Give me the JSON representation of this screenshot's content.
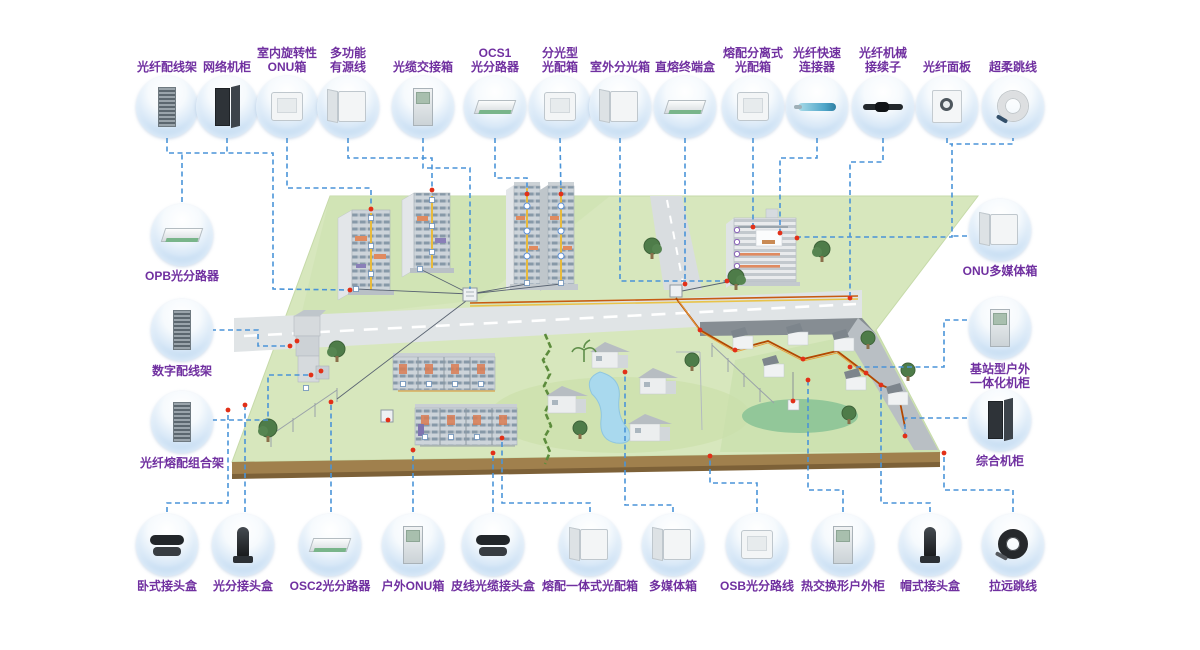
{
  "palette": {
    "label_color": "#7030a0",
    "connector_color": "#4a94d8",
    "node_red": "#e23018",
    "land_green": "#d7e7bd",
    "road_gray": "#dfe3e5",
    "cable_orange": "#c75b12",
    "cable_yellow": "#e8c34a"
  },
  "items": {
    "top": [
      {
        "id": "fiber-distribution-frame",
        "label": "光纤配线架",
        "icon": "rack",
        "cx": 167,
        "cy": 107
      },
      {
        "id": "network-cabinet",
        "label": "网络机柜",
        "icon": "cabinet-dark",
        "cx": 227,
        "cy": 107
      },
      {
        "id": "indoor-rotary-onu-box",
        "label": "室内旋转性\nONU箱",
        "icon": "wallbox",
        "cx": 287,
        "cy": 107
      },
      {
        "id": "multifunction-active-box",
        "label": "多功能\n有源线",
        "icon": "wallbox-open",
        "cx": 348,
        "cy": 107
      },
      {
        "id": "cable-cross-connect-cabinet",
        "label": "光缆交接箱",
        "icon": "cabinet",
        "cx": 423,
        "cy": 107
      },
      {
        "id": "ocs1-splitter",
        "label": "OCS1\n光分路器",
        "icon": "tray",
        "cx": 495,
        "cy": 107
      },
      {
        "id": "splitting-odb",
        "label": "分光型\n光配箱",
        "icon": "wallbox",
        "cx": 560,
        "cy": 107
      },
      {
        "id": "outdoor-splitting-box",
        "label": "室外分光箱",
        "icon": "wallbox-open",
        "cx": 620,
        "cy": 107
      },
      {
        "id": "direct-splice-terminal-box",
        "label": "直熔终端盒",
        "icon": "tray",
        "cx": 685,
        "cy": 107
      },
      {
        "id": "splice-distribution-separate-odb",
        "label": "熔配分离式\n光配箱",
        "icon": "wallbox",
        "cx": 753,
        "cy": 107
      },
      {
        "id": "fiber-quick-connector",
        "label": "光纤快速\n连接器",
        "icon": "connector-blue",
        "cx": 817,
        "cy": 107
      },
      {
        "id": "fiber-mechanical-splice",
        "label": "光纤机械\n接续子",
        "icon": "connector-dark",
        "cx": 883,
        "cy": 107
      },
      {
        "id": "fiber-faceplate",
        "label": "光纤面板",
        "icon": "panel",
        "cx": 947,
        "cy": 107
      },
      {
        "id": "ultra-flexible-patch-cord",
        "label": "超柔跳线",
        "icon": "coil-light",
        "cx": 1013,
        "cy": 107
      }
    ],
    "left": [
      {
        "id": "opb-splitter",
        "label": "OPB光分路器",
        "icon": "tray",
        "cx": 182,
        "cy": 235
      },
      {
        "id": "digital-distribution-frame",
        "label": "数字配线架",
        "icon": "rack",
        "cx": 182,
        "cy": 330
      },
      {
        "id": "fiber-splice-distribution-frame",
        "label": "光纤熔配组合架",
        "icon": "rack",
        "cx": 182,
        "cy": 422
      }
    ],
    "right": [
      {
        "id": "onu-multimedia-box",
        "label": "ONU多媒体箱",
        "icon": "wallbox-open",
        "cx": 1000,
        "cy": 230
      },
      {
        "id": "base-station-outdoor-cabinet",
        "label": "基站型户外\n一体化机柜",
        "icon": "cabinet",
        "cx": 1000,
        "cy": 328
      },
      {
        "id": "integrated-cabinet",
        "label": "综合机柜",
        "icon": "cabinet-dark",
        "cx": 1000,
        "cy": 420
      }
    ],
    "bottom": [
      {
        "id": "horizontal-closure",
        "label": "卧式接头盒",
        "icon": "closure-flat",
        "cx": 167,
        "cy": 545
      },
      {
        "id": "splitting-closure",
        "label": "光分接头盒",
        "icon": "closure-dome",
        "cx": 243,
        "cy": 545
      },
      {
        "id": "osc2-splitter",
        "label": "OSC2光分路器",
        "icon": "tray",
        "cx": 330,
        "cy": 545
      },
      {
        "id": "outdoor-onu-box",
        "label": "户外ONU箱",
        "icon": "cabinet",
        "cx": 413,
        "cy": 545
      },
      {
        "id": "drop-cable-closure",
        "label": "皮线光缆接头盒",
        "icon": "closure-flat",
        "cx": 493,
        "cy": 545
      },
      {
        "id": "integrated-splice-odb",
        "label": "熔配一体式光配箱",
        "icon": "wallbox-open",
        "cx": 590,
        "cy": 545
      },
      {
        "id": "multimedia-box",
        "label": "多媒体箱",
        "icon": "wallbox-open",
        "cx": 673,
        "cy": 545
      },
      {
        "id": "osb-splitter",
        "label": "OSB光分路线",
        "icon": "wallbox",
        "cx": 757,
        "cy": 545
      },
      {
        "id": "heat-exchange-outdoor-cabinet",
        "label": "热交换形户外柜",
        "icon": "cabinet",
        "cx": 843,
        "cy": 545
      },
      {
        "id": "cap-type-closure",
        "label": "帽式接头盒",
        "icon": "closure-dome",
        "cx": 930,
        "cy": 545
      },
      {
        "id": "remote-patch-cord",
        "label": "拉远跳线",
        "icon": "coil-dark",
        "cx": 1013,
        "cy": 545
      }
    ]
  },
  "connectors": [
    {
      "from": "fiber-distribution-frame",
      "points": [
        [
          167,
          138
        ],
        [
          167,
          153
        ],
        [
          273,
          153
        ],
        [
          273,
          289
        ],
        [
          350,
          290
        ]
      ]
    },
    {
      "from": "network-cabinet",
      "points": [
        [
          227,
          138
        ],
        [
          227,
          153
        ]
      ]
    },
    {
      "from": "indoor-rotary-onu-box",
      "points": [
        [
          287,
          138
        ],
        [
          287,
          188
        ],
        [
          371,
          188
        ],
        [
          371,
          211
        ]
      ]
    },
    {
      "from": "multifunction-active-box",
      "points": [
        [
          348,
          138
        ],
        [
          348,
          158
        ],
        [
          432,
          158
        ],
        [
          432,
          192
        ]
      ]
    },
    {
      "from": "cable-cross-connect-cabinet",
      "points": [
        [
          423,
          138
        ],
        [
          423,
          168
        ],
        [
          470,
          168
        ],
        [
          470,
          289
        ]
      ]
    },
    {
      "from": "ocs1-splitter",
      "points": [
        [
          495,
          138
        ],
        [
          495,
          178
        ],
        [
          527,
          178
        ],
        [
          527,
          196
        ]
      ]
    },
    {
      "from": "splitting-odb",
      "points": [
        [
          560,
          138
        ],
        [
          561,
          196
        ]
      ]
    },
    {
      "from": "outdoor-splitting-box",
      "points": [
        [
          620,
          138
        ],
        [
          620,
          281
        ],
        [
          727,
          281
        ]
      ]
    },
    {
      "from": "direct-splice-terminal-box",
      "points": [
        [
          685,
          138
        ],
        [
          685,
          286
        ]
      ]
    },
    {
      "from": "splice-distribution-separate-odb",
      "points": [
        [
          753,
          138
        ],
        [
          753,
          225
        ]
      ]
    },
    {
      "from": "fiber-quick-connector",
      "points": [
        [
          817,
          138
        ],
        [
          817,
          158
        ],
        [
          780,
          158
        ],
        [
          780,
          231
        ]
      ]
    },
    {
      "from": "fiber-mechanical-splice",
      "points": [
        [
          883,
          138
        ],
        [
          883,
          162
        ],
        [
          850,
          162
        ],
        [
          850,
          296
        ]
      ]
    },
    {
      "from": "fiber-faceplate",
      "points": [
        [
          947,
          138
        ],
        [
          947,
          144
        ],
        [
          952,
          144
        ],
        [
          952,
          237
        ],
        [
          797,
          237
        ]
      ]
    },
    {
      "from": "ultra-flexible-patch-cord",
      "points": [
        [
          1013,
          136
        ],
        [
          1013,
          144
        ],
        [
          952,
          144
        ]
      ]
    },
    {
      "from": "opb-splitter",
      "points": [
        [
          182,
          202
        ],
        [
          182,
          153
        ]
      ]
    },
    {
      "from": "digital-distribution-frame",
      "points": [
        [
          211,
          330
        ],
        [
          258,
          330
        ],
        [
          258,
          346
        ],
        [
          290,
          346
        ]
      ]
    },
    {
      "from": "fiber-splice-distribution-frame",
      "points": [
        [
          212,
          420
        ],
        [
          268,
          420
        ],
        [
          268,
          375
        ],
        [
          311,
          375
        ]
      ]
    },
    {
      "from": "onu-multimedia-box",
      "points": [
        [
          967,
          236
        ],
        [
          952,
          236
        ]
      ]
    },
    {
      "from": "base-station-outdoor-cabinet",
      "points": [
        [
          967,
          320
        ],
        [
          944,
          320
        ],
        [
          944,
          367
        ],
        [
          850,
          367
        ]
      ]
    },
    {
      "from": "integrated-cabinet",
      "points": [
        [
          967,
          418
        ],
        [
          905,
          418
        ],
        [
          905,
          436
        ]
      ]
    },
    {
      "from": "horizontal-closure",
      "points": [
        [
          167,
          512
        ],
        [
          167,
          503
        ],
        [
          228,
          503
        ],
        [
          228,
          410
        ]
      ]
    },
    {
      "from": "splitting-closure",
      "points": [
        [
          245,
          512
        ],
        [
          245,
          405
        ]
      ]
    },
    {
      "from": "osc2-splitter",
      "points": [
        [
          331,
          512
        ],
        [
          331,
          404
        ]
      ]
    },
    {
      "from": "outdoor-onu-box",
      "points": [
        [
          413,
          512
        ],
        [
          413,
          452
        ]
      ]
    },
    {
      "from": "drop-cable-closure",
      "points": [
        [
          493,
          512
        ],
        [
          493,
          455
        ]
      ]
    },
    {
      "from": "integrated-splice-odb",
      "points": [
        [
          590,
          512
        ],
        [
          590,
          503
        ],
        [
          502,
          503
        ],
        [
          502,
          440
        ]
      ]
    },
    {
      "from": "multimedia-box",
      "points": [
        [
          673,
          512
        ],
        [
          673,
          505
        ],
        [
          625,
          505
        ],
        [
          625,
          374
        ]
      ]
    },
    {
      "from": "osb-splitter",
      "points": [
        [
          757,
          512
        ],
        [
          757,
          483
        ],
        [
          710,
          483
        ],
        [
          710,
          458
        ]
      ]
    },
    {
      "from": "heat-exchange-outdoor-cabinet",
      "points": [
        [
          843,
          512
        ],
        [
          843,
          490
        ],
        [
          808,
          490
        ],
        [
          808,
          382
        ]
      ]
    },
    {
      "from": "cap-type-closure",
      "points": [
        [
          930,
          512
        ],
        [
          930,
          503
        ],
        [
          881,
          503
        ],
        [
          881,
          386
        ]
      ]
    },
    {
      "from": "remote-patch-cord",
      "points": [
        [
          1013,
          512
        ],
        [
          1013,
          490
        ],
        [
          944,
          490
        ],
        [
          944,
          455
        ]
      ]
    }
  ],
  "scene": {
    "red_nodes": [
      [
        350,
        290
      ],
      [
        371,
        209
      ],
      [
        432,
        190
      ],
      [
        527,
        194
      ],
      [
        561,
        194
      ],
      [
        727,
        281
      ],
      [
        753,
        227
      ],
      [
        780,
        233
      ],
      [
        850,
        298
      ],
      [
        797,
        238
      ],
      [
        850,
        367
      ],
      [
        905,
        436
      ],
      [
        290,
        346
      ],
      [
        311,
        375
      ],
      [
        228,
        410
      ],
      [
        245,
        405
      ],
      [
        331,
        402
      ],
      [
        388,
        420
      ],
      [
        413,
        450
      ],
      [
        493,
        453
      ],
      [
        502,
        438
      ],
      [
        625,
        372
      ],
      [
        710,
        456
      ],
      [
        808,
        380
      ],
      [
        881,
        385
      ],
      [
        944,
        453
      ],
      [
        685,
        284
      ],
      [
        700,
        330
      ],
      [
        735,
        350
      ],
      [
        803,
        359
      ],
      [
        866,
        373
      ],
      [
        297,
        341
      ],
      [
        321,
        371
      ],
      [
        793,
        401
      ]
    ],
    "box_nodes": [
      [
        371,
        218
      ],
      [
        371,
        246
      ],
      [
        371,
        274
      ],
      [
        432,
        200
      ],
      [
        432,
        226
      ],
      [
        432,
        252
      ],
      [
        527,
        283
      ],
      [
        561,
        283
      ],
      [
        356,
        289
      ],
      [
        420,
        269
      ],
      [
        403,
        384
      ],
      [
        429,
        384
      ],
      [
        455,
        384
      ],
      [
        481,
        384
      ],
      [
        425,
        437
      ],
      [
        451,
        437
      ],
      [
        477,
        437
      ],
      [
        306,
        388
      ]
    ]
  }
}
